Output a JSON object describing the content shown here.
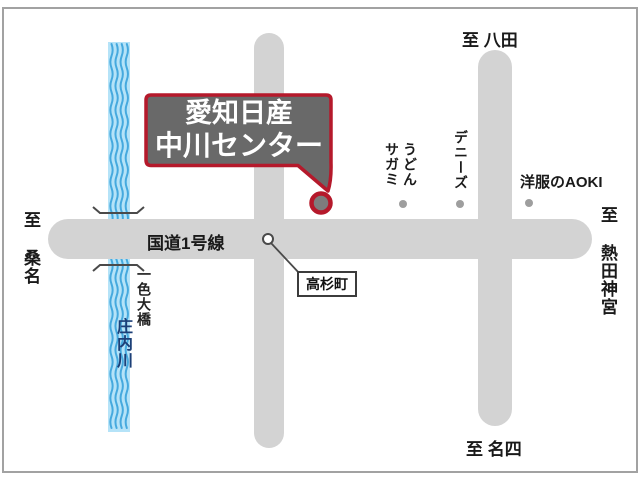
{
  "map": {
    "callout": {
      "line1": "愛知日産",
      "line2": "中川センター"
    },
    "roads": {
      "route1_label": "国道1号線",
      "intersection_label": "高杉町"
    },
    "directions": {
      "top_right": "至 八田",
      "left": "至 桑名",
      "right": "至 熱田神宮",
      "bottom_right": "至 名四"
    },
    "river": {
      "name": "庄内川",
      "bridge_name": "一色大橋"
    },
    "pois": {
      "udon_sagami": "うどん\nサガミ",
      "dennys": "デニーズ",
      "aoki": "洋服のAOKI"
    },
    "colors": {
      "road_gray": "#d3d3d3",
      "river_fill": "#b5e3f8",
      "river_wave": "#45a9de",
      "river_text_navy": "#1c3f77",
      "callout_fill": "#696969",
      "callout_border_red": "#b5192b",
      "marker_inner_gray": "#7d7d7d",
      "poi_dot_gray": "#9e9e9e"
    }
  }
}
